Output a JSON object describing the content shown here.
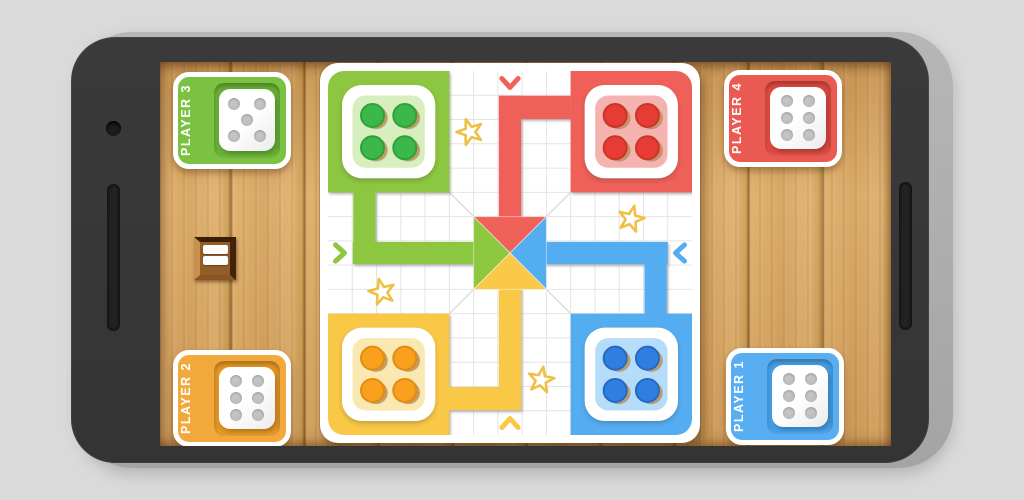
{
  "players": [
    {
      "label": "PLAYER 3",
      "corner": "top-left",
      "color": "#7CC242",
      "inset_color": "#69B236",
      "dice_value": 5
    },
    {
      "label": "PLAYER 4",
      "corner": "top-right",
      "color": "#EA5A52",
      "inset_color": "#DE4A42",
      "dice_value": 6
    },
    {
      "label": "PLAYER 2",
      "corner": "bottom-left",
      "color": "#F2A93C",
      "inset_color": "#E69724",
      "dice_value": 6
    },
    {
      "label": "PLAYER 1",
      "corner": "bottom-right",
      "color": "#58AEF0",
      "inset_color": "#45A0E8",
      "dice_value": 6
    }
  ],
  "dice": {
    "pip_color": "#C6C6C6"
  },
  "board": {
    "grid": 15,
    "grid_color": "#E4E4E4",
    "diagonal_color": "#D8D8D8",
    "token_base_color": "#C9995B",
    "star_stroke": "#EEC043",
    "seats": {
      "green": {
        "quadrant": "top-left",
        "path_color": "#8DC63F",
        "home_color": "#D7EEBE",
        "token_color": "#3CB84B",
        "token_ring": "#2FA13C",
        "tokens": 4,
        "entry_chevron": "chevron-right-icon"
      },
      "red": {
        "quadrant": "top-right",
        "path_color": "#EF6159",
        "home_color": "#F4B3AF",
        "token_color": "#E63C33",
        "token_ring": "#C9352C",
        "tokens": 4,
        "entry_chevron": "chevron-down-icon"
      },
      "yellow": {
        "quadrant": "bottom-left",
        "path_color": "#F9C846",
        "home_color": "#FAE8B0",
        "token_color": "#F9A11F",
        "token_ring": "#DF8D12",
        "tokens": 4,
        "entry_chevron": "chevron-up-icon"
      },
      "blue": {
        "quadrant": "bottom-right",
        "path_color": "#55ADF1",
        "home_color": "#B5DCF8",
        "token_color": "#2F7FE1",
        "token_ring": "#2668C4",
        "tokens": 4,
        "entry_chevron": "chevron-left-icon"
      }
    },
    "stars": [
      {
        "x": 142,
        "y": 61,
        "rot": -18
      },
      {
        "x": 303,
        "y": 148,
        "rot": 14
      },
      {
        "x": 54,
        "y": 221,
        "rot": -14
      },
      {
        "x": 213,
        "y": 309,
        "rot": 10
      }
    ]
  },
  "menu_box": {
    "icon": "menu-bars-icon",
    "bars": 2
  }
}
